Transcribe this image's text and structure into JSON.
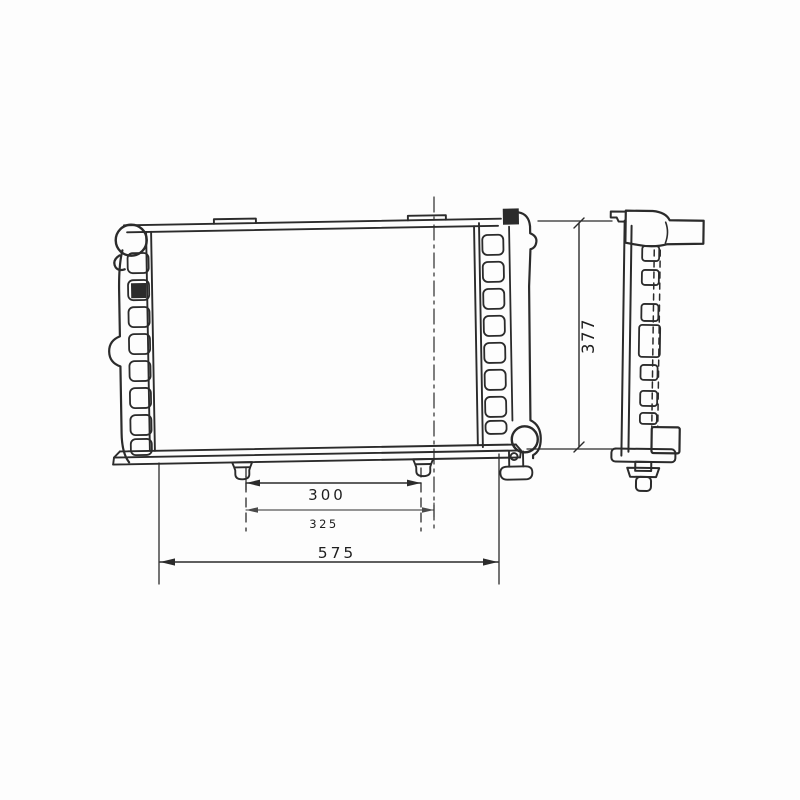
{
  "drawing_type": "radiator-engineering-drawing",
  "colors": {
    "line": "#2b2b2b",
    "line_light": "#4a4a4a",
    "background": "#fdfdfd"
  },
  "dimensions": {
    "pin_spacing": "300",
    "bracket_spacing": "325",
    "overall_width": "575",
    "overall_height": "377"
  }
}
